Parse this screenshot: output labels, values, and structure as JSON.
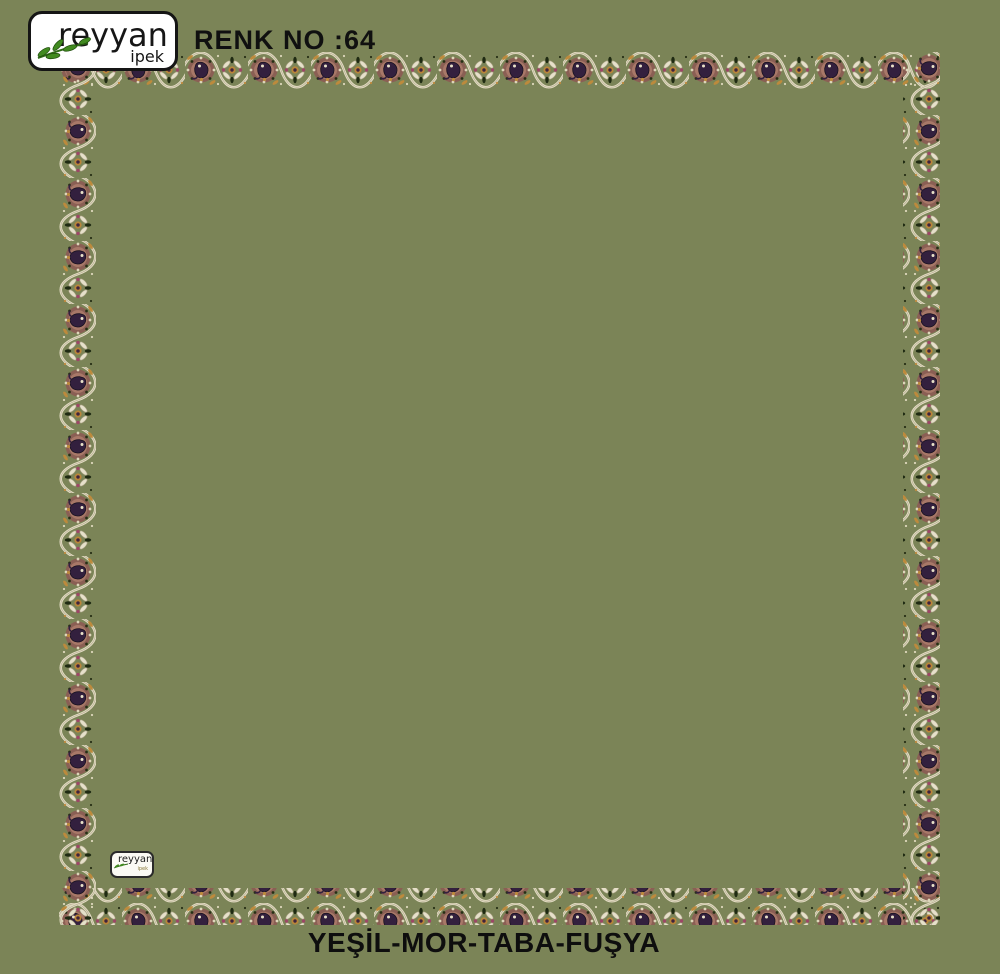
{
  "colors": {
    "background": "#7b8457",
    "ink": "#101010",
    "logo_box_bg": "#ffffff",
    "logo_border": "#151515",
    "logo_leaf_green": "#3f8a1e",
    "border_palette": {
      "vine_cream": "#e3dcc4",
      "rosette_mauve": "#a87868",
      "rosette_outer": "#8a5f54",
      "paisley_purple": "#33203e",
      "taba_orange": "#bd8a3c",
      "fuchsia": "#9c4766",
      "leaf_dark": "#1f2a12"
    }
  },
  "header": {
    "brand": "reyyan",
    "brand_sub": "ipek",
    "renk_label": "RENK NO :64"
  },
  "scarf": {
    "inner_tag_brand": "reyyan",
    "inner_tag_sub": "ipek"
  },
  "footer": {
    "colorway": "YEŞİL-MOR-TABA-FUŞYA"
  }
}
